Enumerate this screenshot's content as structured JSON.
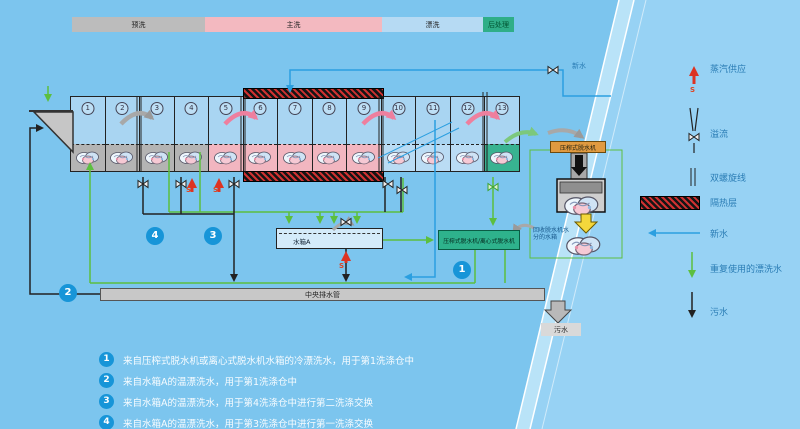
{
  "phase_bar": {
    "segments": [
      {
        "label": "预洗"
      },
      {
        "label": "主洗"
      },
      {
        "label": "漂洗"
      },
      {
        "label": "后处理"
      }
    ]
  },
  "machine": {
    "compartments": [
      "1",
      "2",
      "3",
      "4",
      "5",
      "6",
      "7",
      "8",
      "9",
      "10",
      "11",
      "12",
      "13"
    ]
  },
  "labels": {
    "fresh_water": "新水",
    "steam_s": "S",
    "tank_a": "水箱A",
    "central_drain_pipe": "中央排水管",
    "sewage": "污水",
    "press_dehydrator": "压榨式脱水机",
    "press_or_centrifuge": "压榨式脱水机/离心式脱水机",
    "recovery_note": "回收脱水机水分的水箱"
  },
  "legend": {
    "items": [
      {
        "icon": "steam-supply-arrow",
        "label": "蒸汽供应"
      },
      {
        "icon": "overflow-valve",
        "label": "溢流"
      },
      {
        "icon": "double-spiral-line",
        "label": "双螺旋线"
      },
      {
        "icon": "insulation-layer",
        "label": "隔热层"
      },
      {
        "icon": "fresh-water-arrow",
        "label": "新水"
      },
      {
        "icon": "reused-rinse-water-arrow",
        "label": "重复使用的漂洗水"
      },
      {
        "icon": "sewage-arrow",
        "label": "污水"
      }
    ]
  },
  "diagram_badges": [
    {
      "num": "1"
    },
    {
      "num": "2"
    },
    {
      "num": "3"
    },
    {
      "num": "4"
    }
  ],
  "annotations": [
    {
      "num": "1",
      "text": "来自压榨式脱水机或离心式脱水机水箱的冷漂洗水，用于第1洗涤仓中"
    },
    {
      "num": "2",
      "text": "来自水箱A的温漂洗水，用于第1洗涤仓中"
    },
    {
      "num": "3",
      "text": "来自水箱A的温漂洗水，用于第4洗涤仓中进行第二洗涤交换"
    },
    {
      "num": "4",
      "text": "来自水箱A的温漂洗水，用于第3洗涤仓中进行第一洗涤交换"
    }
  ],
  "colors": {
    "badge_blue": "#1795d8",
    "reuse_green": "#5cbf3f",
    "fresh_blue": "#2b9fe0",
    "steam_red": "#dd3322",
    "phase_prewash": "#bcbcbc",
    "phase_main": "#f3b9c0",
    "phase_rinse": "#b6daf3",
    "phase_after": "#2fae88"
  }
}
